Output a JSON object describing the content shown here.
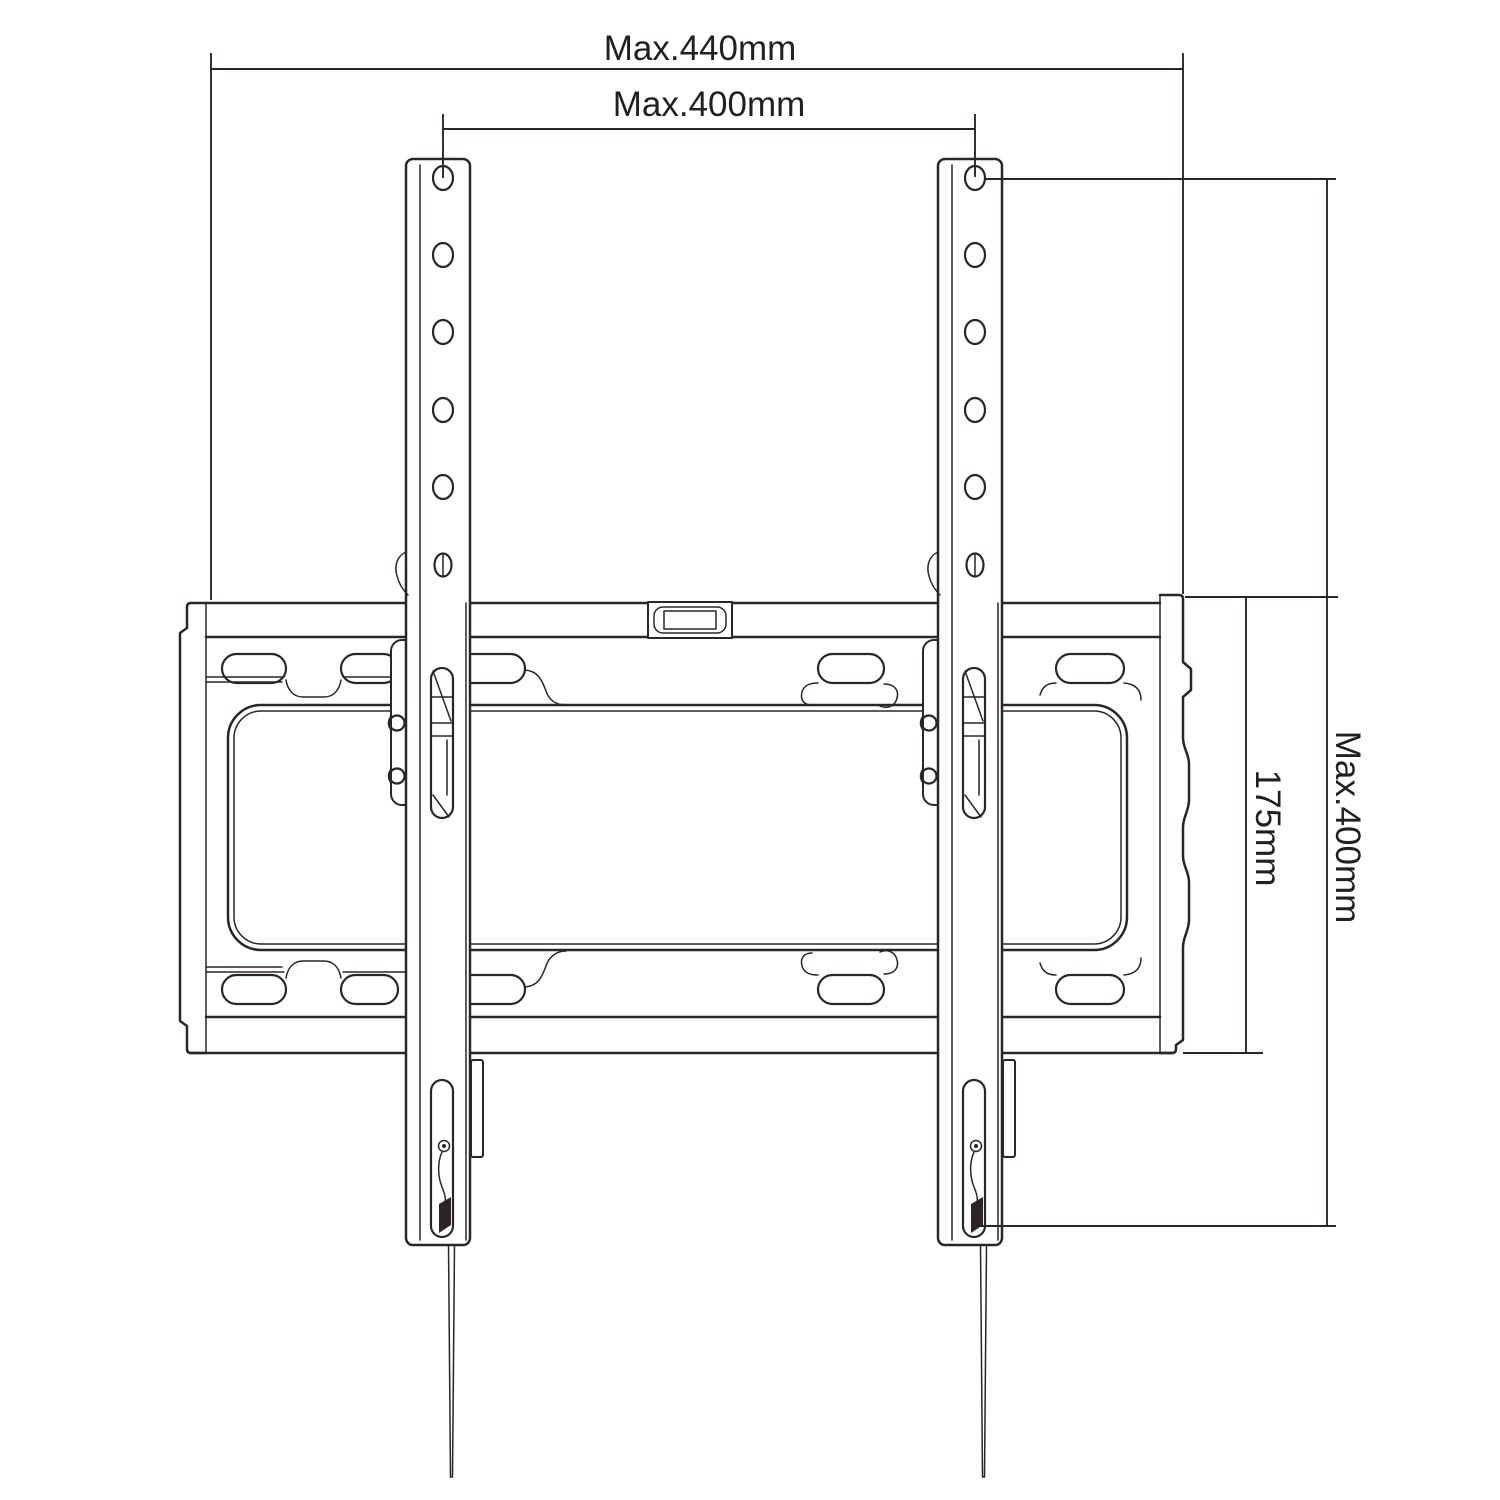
{
  "drawing": {
    "description": "Tilting TV wall mount bracket dimension drawing",
    "background_color": "#ffffff",
    "line_color": "#2b2526",
    "labels": {
      "overall_width": "Max.440mm",
      "mount_hole_width": "Max.400mm",
      "plate_height": "175mm",
      "mount_hole_height": "Max.400mm"
    }
  }
}
